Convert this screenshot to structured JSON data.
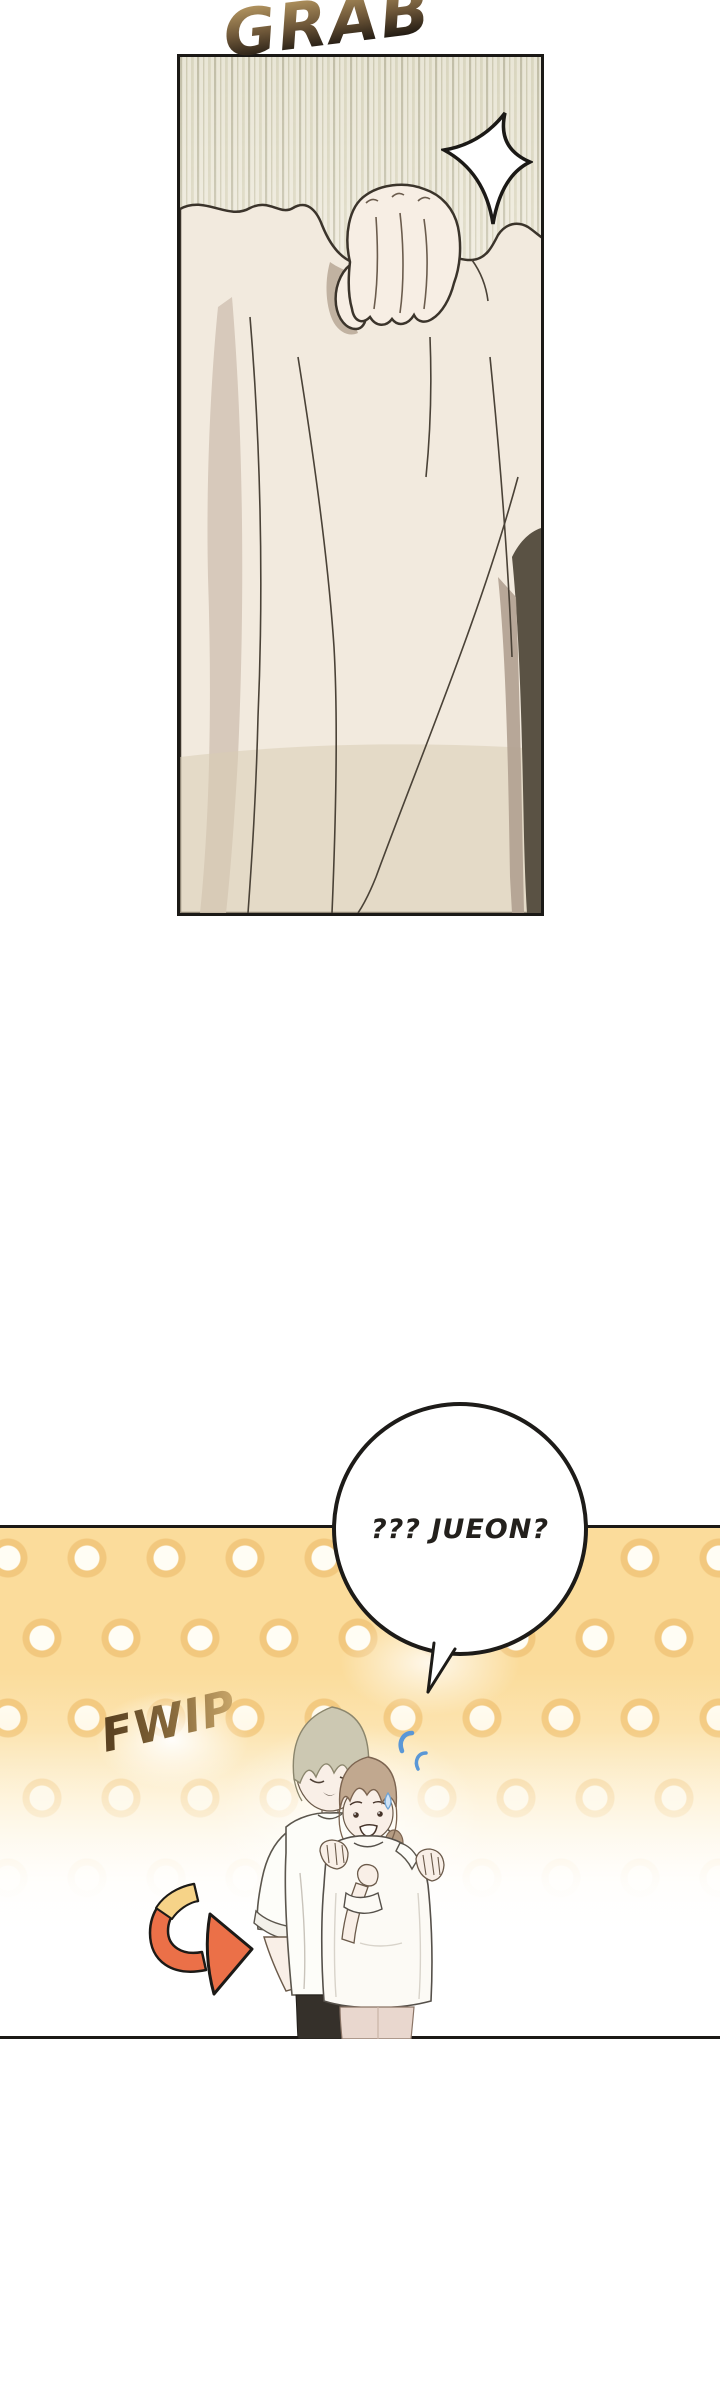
{
  "comic": {
    "panel1": {
      "sfx_grab": "GRAB"
    },
    "panel2": {
      "sfx_fwip": "FWIP",
      "bubble_text": "??? JUEON?"
    },
    "icons": {
      "impact_star": "four-point-flash-star",
      "motion_arrow": "orange-curved-swoosh-arrow",
      "confusion_marks": "blue-flustered-marks",
      "sweat_drop": "nervous-sweat-drop"
    },
    "colors": {
      "panel_border": "#1b1916",
      "grab_gradient_top": "#b2945f",
      "grab_gradient_bottom": "#17120d",
      "fwip_gradient_dark": "#5c4322",
      "fwip_gradient_light": "#c6a468",
      "polka_background": "#fbdc9b",
      "polka_dot_ring": "#f2c87e",
      "arrow_orange": "#eb7048",
      "arrow_yellow": "#f6d388",
      "confusion_blue": "#5a97d6",
      "tall_hair": "#ccc8b2",
      "short_hair": "#c1a88f",
      "skin": "#f9efe7",
      "dark_pants": "#35302a",
      "light_pants": "#e9d7ce"
    }
  }
}
